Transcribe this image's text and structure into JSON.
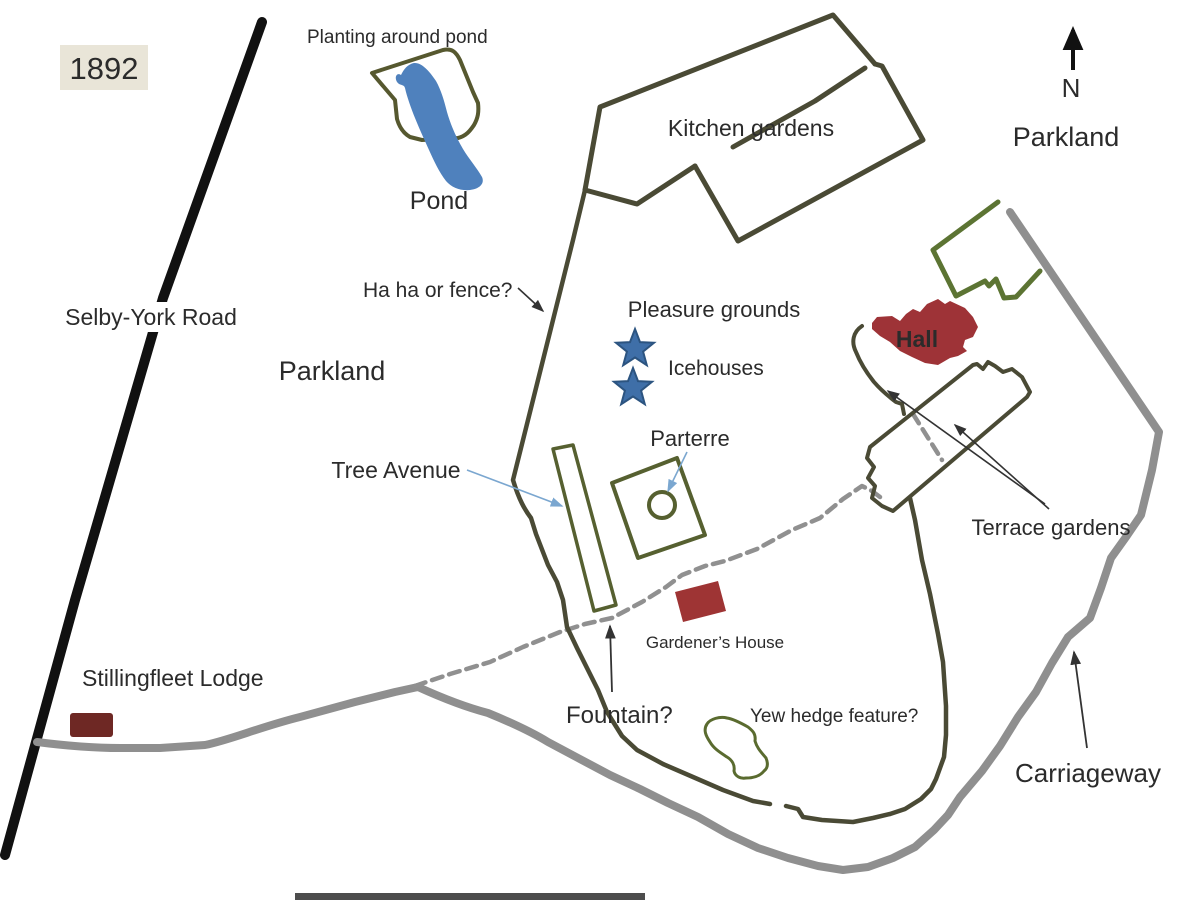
{
  "title": "Estate plan map, 1892",
  "year_box": {
    "label": "1892"
  },
  "labels": {
    "selby_york_road": "Selby-York Road",
    "planting_around_pond": "Planting around pond",
    "pond": "Pond",
    "kitchen_gardens": "Kitchen gardens",
    "parkland_left": "Parkland",
    "parkland_right": "Parkland",
    "north": "N",
    "ha_ha": "Ha ha or fence?",
    "pleasure_grounds": "Pleasure grounds",
    "icehouses": "Icehouses",
    "parterre": "Parterre",
    "tree_avenue": "Tree Avenue",
    "hall": "Hall",
    "terrace_gardens": "Terrace gardens",
    "gardeners_house": "Gardener’s House",
    "fountain": "Fountain?",
    "yew_hedge": "Yew hedge feature?",
    "stillingfleet_lodge": "Stillingfleet Lodge",
    "carriageway": "Carriageway"
  },
  "colors": {
    "background": "#ffffff",
    "text": "#2b2b2b",
    "road_black": "#111111",
    "carriageway_gray": "#8f8f8f",
    "dashed_path_gray": "#909090",
    "boundary_olive": "#4a4a35",
    "garden_olive": "#566030",
    "planting_olive": "#56582f",
    "hedge_green": "#5a6b2f",
    "bright_green": "#5c7433",
    "pond_blue": "#4f81bd",
    "star_blue": "#3f6fa8",
    "star_border": "#2c5480",
    "hall_red": "#9e3337",
    "gardeners_house_red": "#9e3434",
    "lodge_red": "#6e2824",
    "arrow_black": "#333333",
    "arrow_blue": "#7ba7d0",
    "year_box_bg": "#e9e5d8",
    "bottom_strip": "#2e2e2e"
  }
}
